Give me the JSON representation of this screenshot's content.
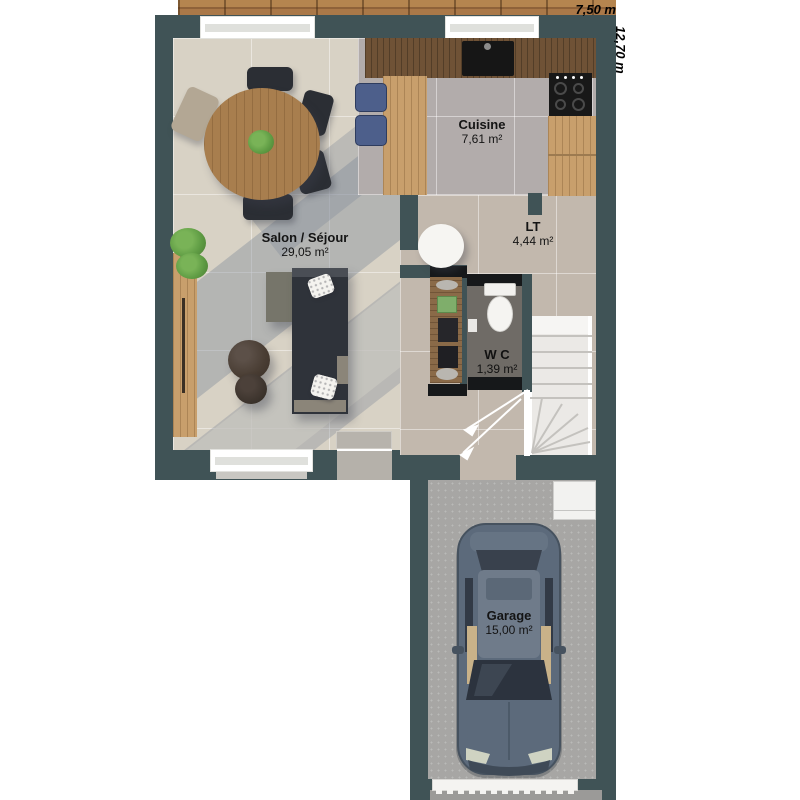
{
  "plan": {
    "type": "house-floor-plan",
    "rooms": [
      {
        "id": "cuisine",
        "name": "Cuisine",
        "area": "7,61 m²"
      },
      {
        "id": "salon",
        "name": "Salon / Séjour",
        "area": "29,05 m²"
      },
      {
        "id": "lt",
        "name": "LT",
        "area": "4,44 m²"
      },
      {
        "id": "wc",
        "name": "W C",
        "area": "1,39 m²"
      },
      {
        "id": "garage",
        "name": "Garage",
        "area": "15,00 m²"
      }
    ],
    "dimensions": {
      "width_label": "7,50 m",
      "height_label": "12,70 m"
    },
    "colors": {
      "wall": "#405356",
      "living_floor": "#d8d2c5",
      "kitchen_floor": "#b2acab",
      "hall_floor": "#c2b8ad",
      "wc_floor": "#6f6b66",
      "garage_floor": "#a7a6a4",
      "deck_wood": "#aa7848",
      "counter_dark_wood": "#6f5236",
      "counter_light_wood": "#c89f6c",
      "sofa": "#2f333a",
      "stool_blue": "#4d5f8b",
      "car_body": "#5c6a7b",
      "label_text": "#141414"
    }
  }
}
